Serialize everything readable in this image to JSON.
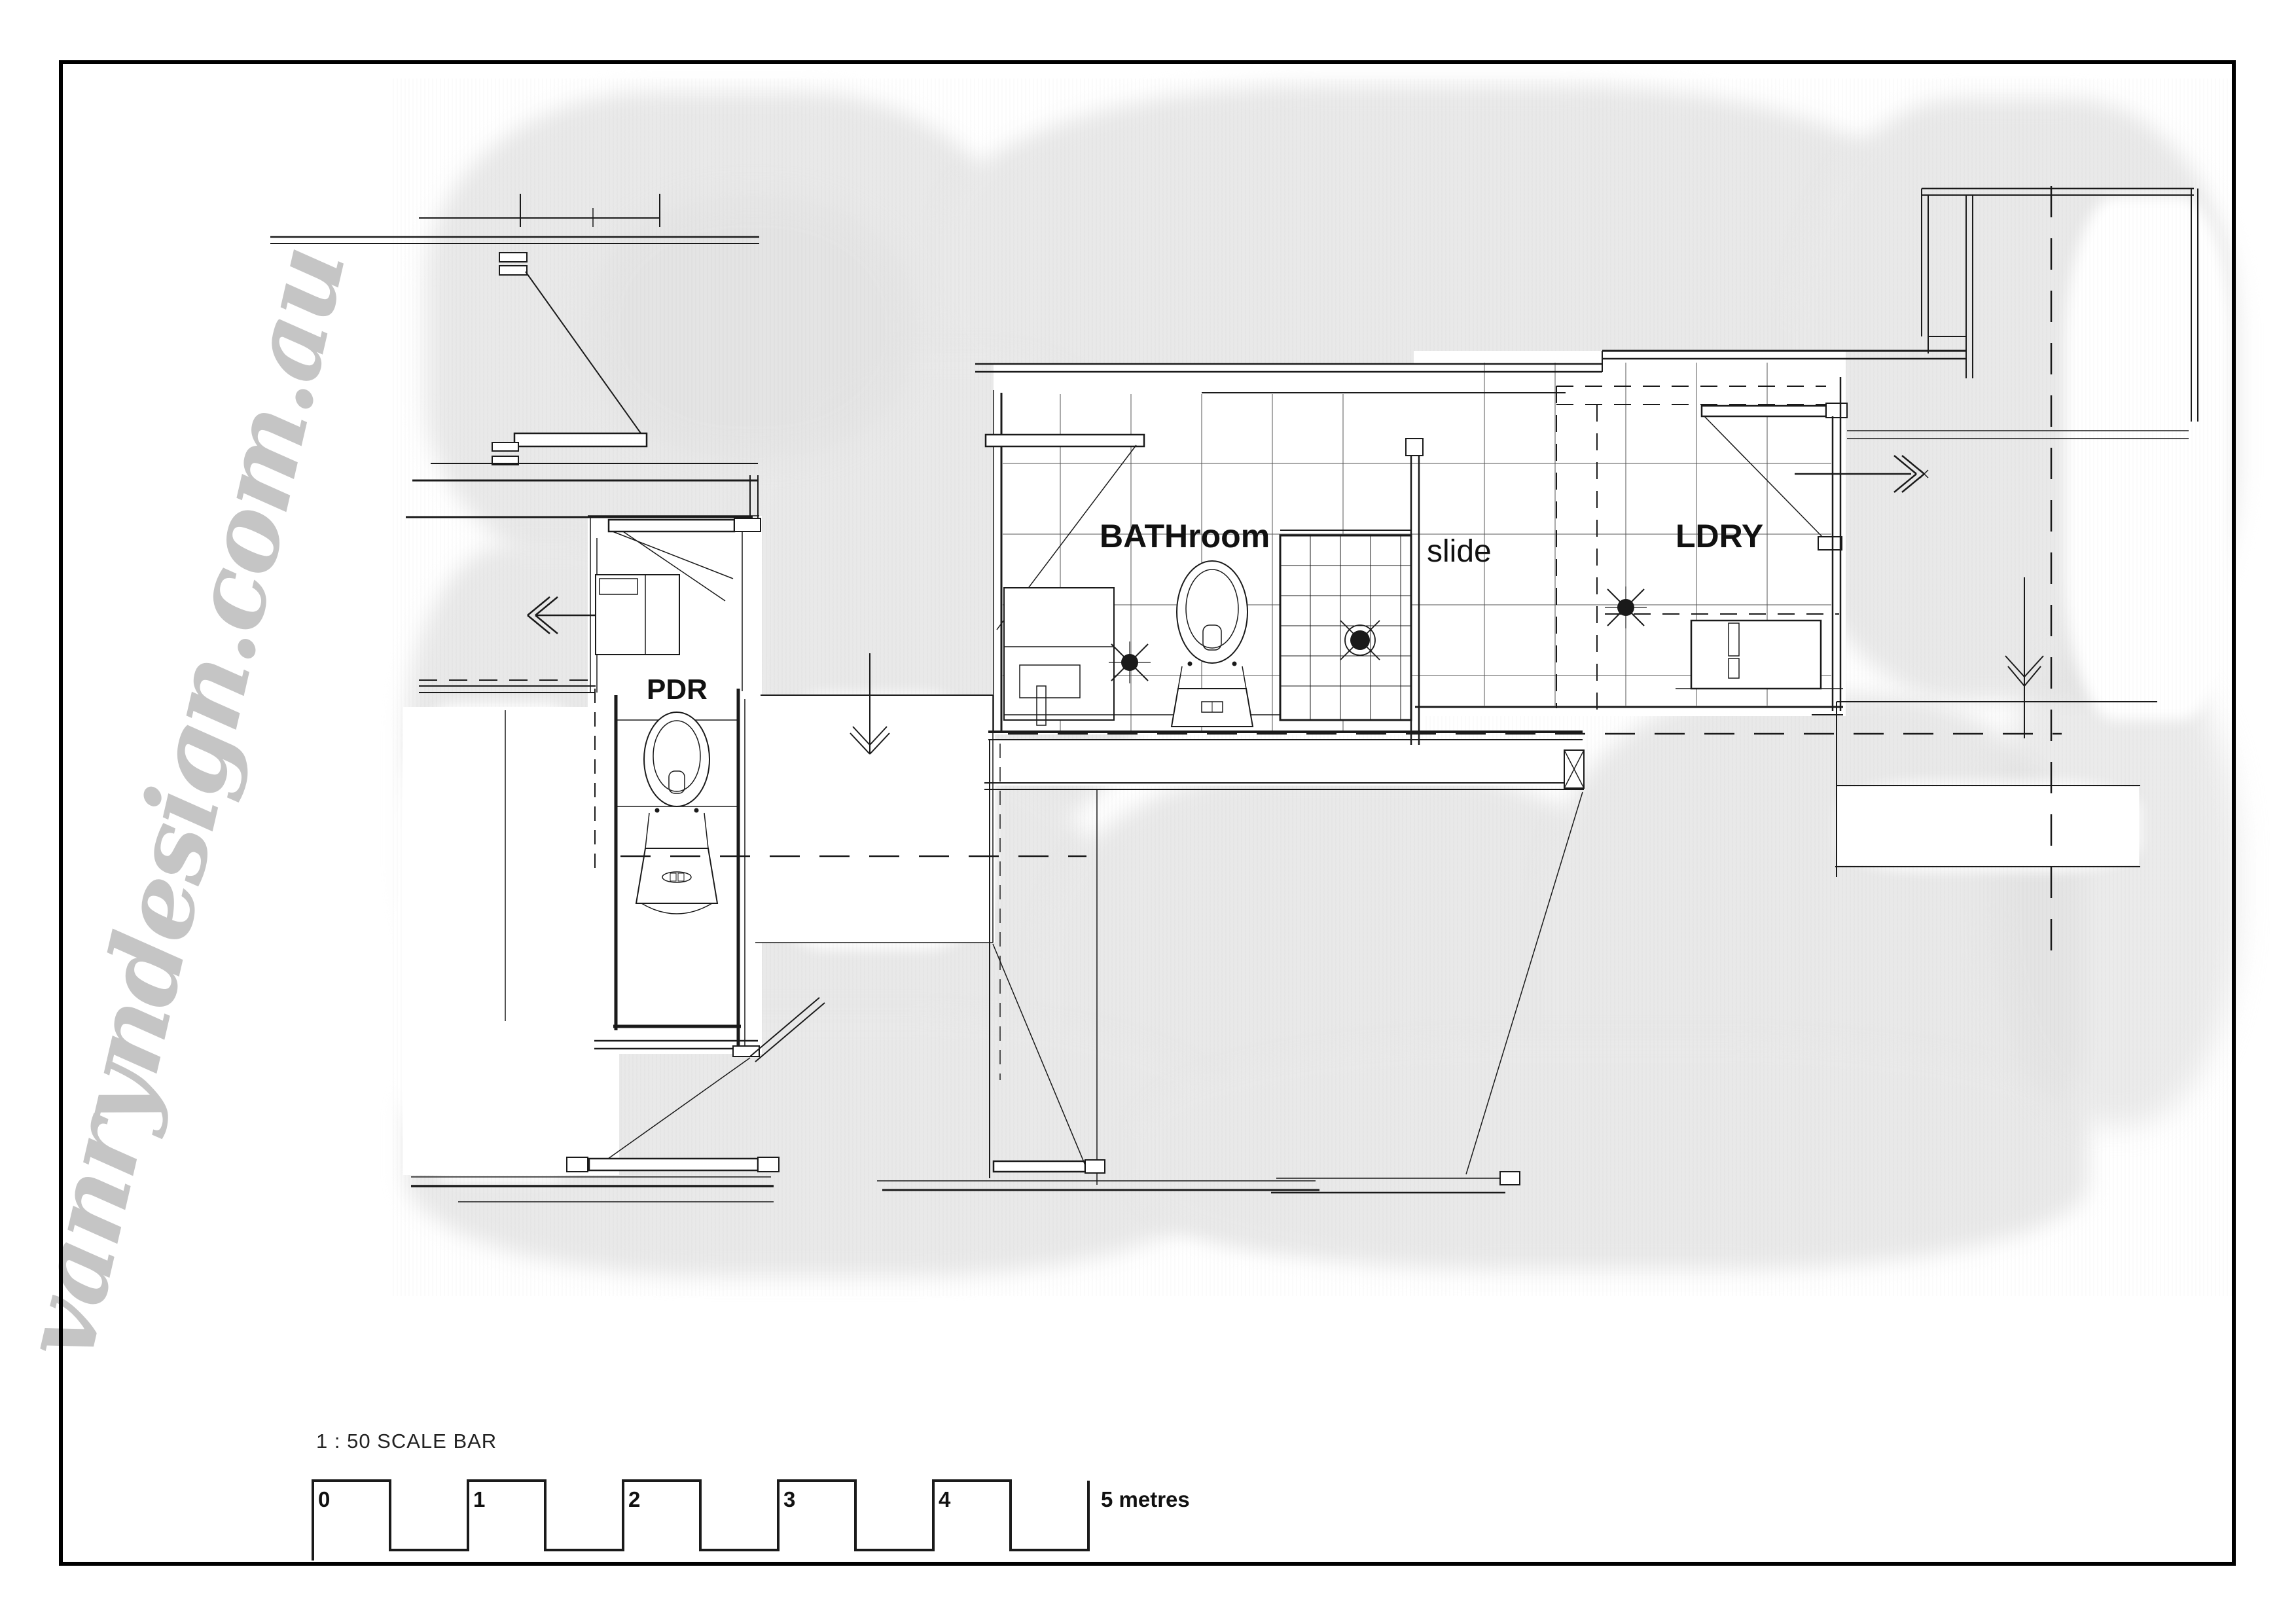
{
  "watermark": {
    "text": "vanryndesign.com.au",
    "color": "#c5c5c5"
  },
  "labels": {
    "bathroom": "BATHroom",
    "slide": "slide",
    "laundry": "LDRY",
    "powder_room": "PDR"
  },
  "scale_bar": {
    "title": "1 : 50 SCALE BAR",
    "ticks": [
      "0",
      "1",
      "2",
      "3",
      "4"
    ],
    "end_label": "5 metres"
  },
  "colors": {
    "paper": "#ffffff",
    "frame": "#000000",
    "line": "#1a1a1a",
    "grid": "#555555",
    "wash": "#e9e9e9",
    "watermark": "#c5c5c5"
  }
}
